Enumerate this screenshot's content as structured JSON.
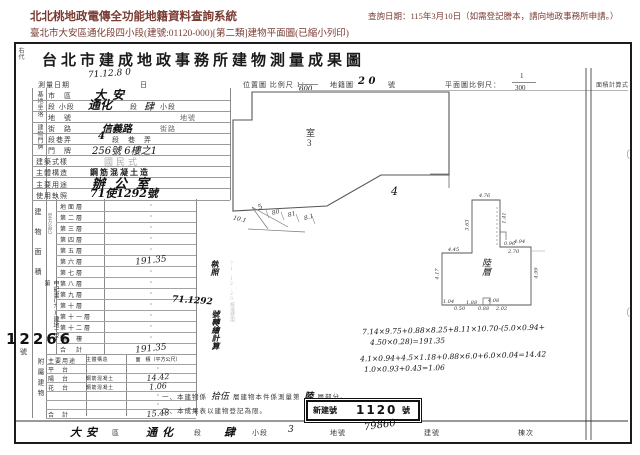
{
  "page": {
    "system_title": "北北桃地政電傳全功能地籍資料查詢系統",
    "doc_line": "臺北市大安區通化段四小段(建號:01120-000)[第二類]建物平面圖(已縮小列印)",
    "query_date": "查詢日期：115年3月10日（如需登記謄本，請向地政事務所申請。）"
  },
  "form": {
    "side_label": "右代",
    "title": "台北市建成地政事務所建物測量成果圖",
    "header_row": {
      "survey_date_label": "測量日期",
      "survey_date_value": "71.12.8 0",
      "survey_date_unit": "日",
      "loc_map_label": "位置圖 比例尺 1：",
      "loc_map_value": "600",
      "cad_map_label": "地籍圖",
      "cad_map_value": "2 0",
      "cad_map_unit": "號",
      "plan_scale_label": "平面圖比例尺：",
      "plan_scale_num": "1",
      "plan_scale_den": "300",
      "area_calc_label": "面積計算式"
    },
    "group_labels": {
      "site": "基地坐落",
      "door": "建物門牌",
      "area_section": "建物面積",
      "area_unit": "（平方公尺）",
      "annex_section": "附屬建物"
    },
    "fields": [
      {
        "label": "市　區",
        "value": "大安"
      },
      {
        "label": "段 小段",
        "value": "通化",
        "mid": "段",
        "hand2": "肆",
        "suffix": "小段"
      },
      {
        "label": "地　號",
        "value": "",
        "suffix": "地號"
      },
      {
        "label": "街　路",
        "value": "信義路",
        "suffix": "街路"
      },
      {
        "label": "段巷弄",
        "value": "4",
        "suffix": "段　巷　弄"
      },
      {
        "label": "門　牌",
        "value": "256號 6樓之1",
        "suffix": ""
      },
      {
        "label": "建築式樣",
        "value": "國民式"
      },
      {
        "label": "主體構造",
        "value": "鋼筋混凝土造"
      },
      {
        "label": "主要用途",
        "value": "辦公室"
      },
      {
        "label": "使用執照",
        "value": "71使1292號"
      }
    ],
    "floors": [
      {
        "label": "地面層",
        "value": "·"
      },
      {
        "label": "第二層",
        "value": "·"
      },
      {
        "label": "第三層",
        "value": "·"
      },
      {
        "label": "第四層",
        "value": "·"
      },
      {
        "label": "第五層",
        "value": "·"
      },
      {
        "label": "第六層",
        "value": "191.35"
      },
      {
        "label": "第七層",
        "value": "·"
      },
      {
        "label": "第八層",
        "value": "·"
      },
      {
        "label": "第九層",
        "value": "·"
      },
      {
        "label": "第十層",
        "value": "·"
      },
      {
        "label": "第十一層",
        "value": "·"
      },
      {
        "label": "第十二層",
        "value": "·"
      },
      {
        "label": "騎　樓",
        "value": "·"
      },
      {
        "label": "合　計",
        "value": "191.35"
      }
    ],
    "annex": {
      "headers": [
        "主要用途",
        "主體構造",
        "面　積（平方公尺）"
      ],
      "rows": [
        {
          "use": "平　台",
          "structure": "",
          "area": "·"
        },
        {
          "use": "陽　台",
          "structure": "鋼筋混凝土",
          "area": "14.42"
        },
        {
          "use": "花　台",
          "structure": "鋼筋混凝土",
          "area": "1.06"
        },
        {
          "use": "",
          "structure": "",
          "area": "·"
        },
        {
          "use": "",
          "structure": "",
          "area": "·"
        },
        {
          "use": "合　計",
          "structure": "",
          "area": "15.48"
        }
      ]
    },
    "stamp_12266": {
      "vertical": "申記書(7)建地二字第",
      "number": "12266",
      "suffix": "號"
    },
    "exec_note": {
      "top": "執照",
      "number": "71.1292",
      "bottom": "號轉繪計算",
      "faint": "71.12.20核准使用"
    },
    "calc_lines": [
      "7.14×9.75+0.88×8.25+8.11×10.70-(5.0×0.94+",
      "4.50×0.28)=191.35",
      "4.1×0.94+4.5×1.18+0.88×6.0+6.0×0.04=14.42",
      "1.0×0.93+0.43=1.06"
    ],
    "notes": {
      "n1_pre": "一、本建物係",
      "n1_h1": "拾伍",
      "n1_mid": "層建物本件係測量第",
      "n1_h2": "陸",
      "n1_suf": "層部分。",
      "n2": "二、本成果表以建物登記為限。"
    },
    "new_no_stamp": {
      "label": "新建號",
      "number": "1120",
      "unit": "號"
    },
    "footer": {
      "district": "大安",
      "district_label": "區",
      "section": "通化",
      "section_label": "段",
      "subsection": "肆",
      "subsection_label": "小段",
      "parcel": "3",
      "parcel_label": "地號",
      "parcel_no": "79860",
      "building_label": "建號",
      "unit_label": "棟次"
    }
  },
  "drawing": {
    "room_label": "室",
    "room_no": "3",
    "mark_4": "4",
    "floor_tag": "陸層",
    "base_dims": [
      "10.1",
      "5",
      "80",
      "81",
      "8.1"
    ],
    "small_dims": [
      "4.76",
      "3.63",
      "1.41",
      "0.96",
      "4.94",
      "2.70",
      "4.45",
      "4.17",
      "4.99",
      "1.04",
      "0.50",
      "1.88",
      "0.88",
      "2.02",
      "4.08"
    ],
    "paren": "（"
  }
}
